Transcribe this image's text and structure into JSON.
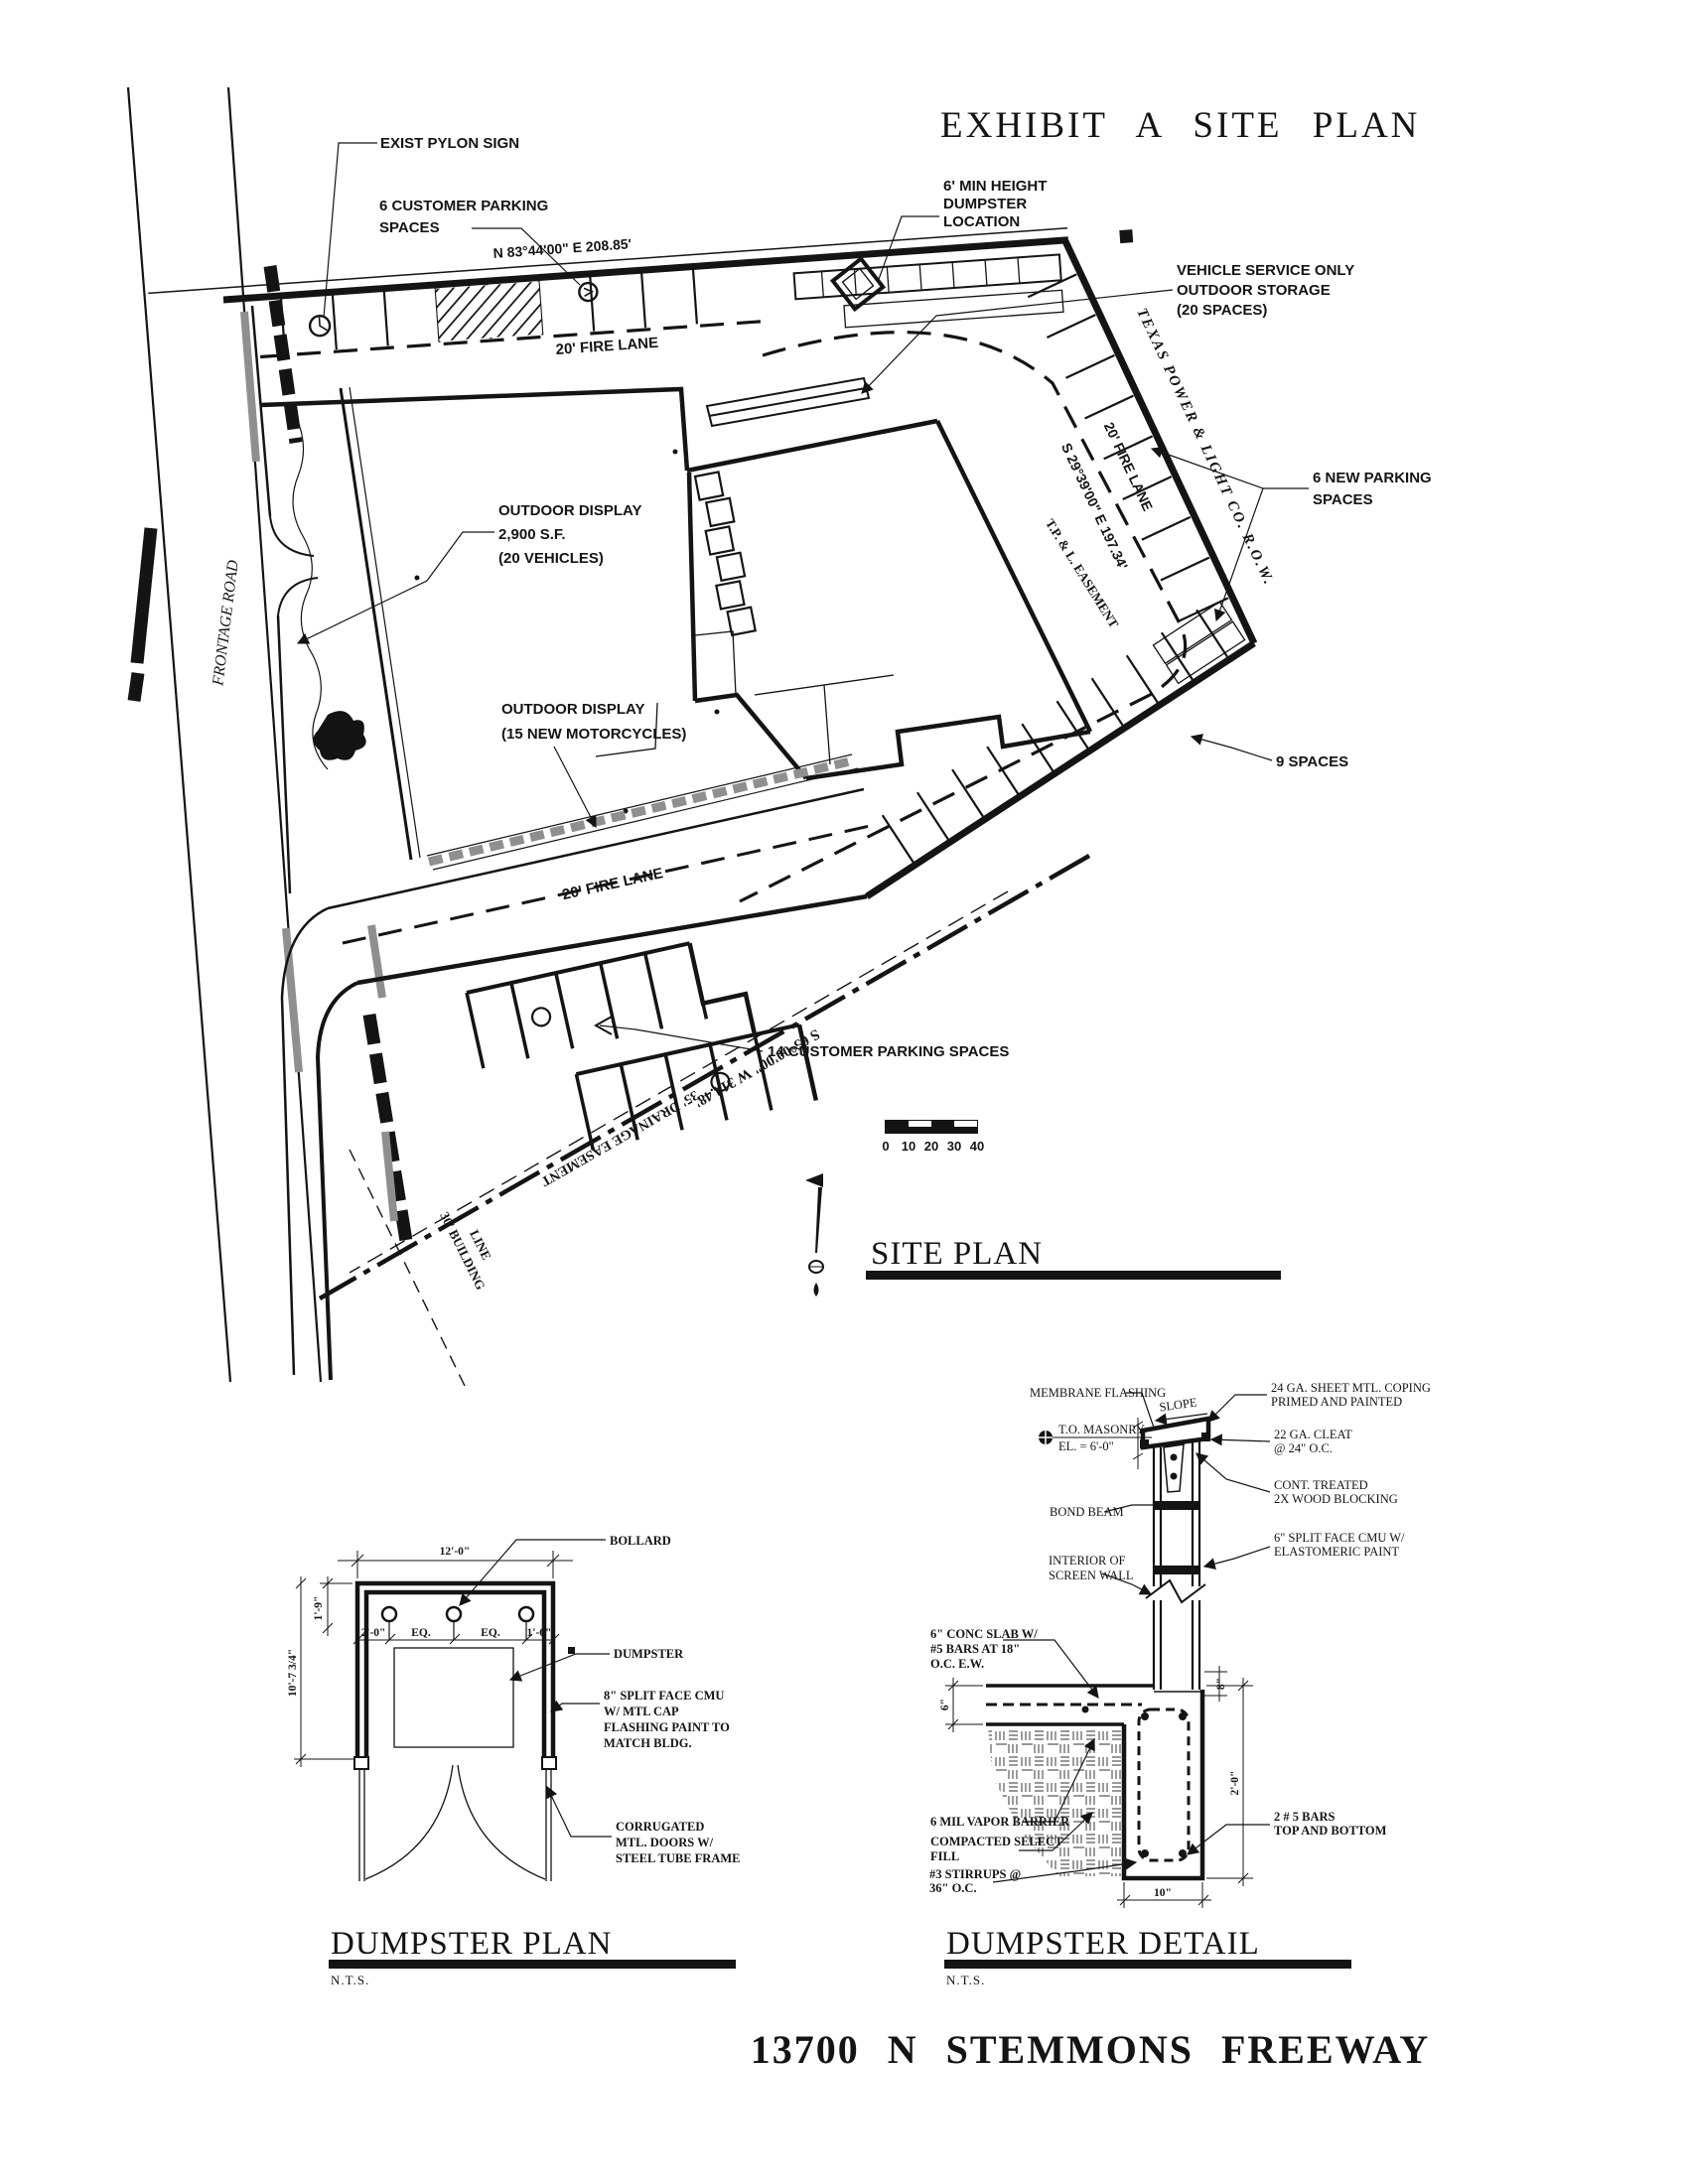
{
  "colors": {
    "ink": "#141414",
    "gray": "#8f8f8f",
    "paper": "#ffffff"
  },
  "exhibit_title": "EXHIBIT  A  SITE  PLAN",
  "address": "13700  N  STEMMONS  FREEWAY",
  "site": {
    "heading": "SITE PLAN",
    "exist_pylon_sign": "EXIST PYLON SIGN",
    "customer_parking_6": [
      "6 CUSTOMER PARKING",
      "SPACES"
    ],
    "dumpster_location": [
      "6' MIN HEIGHT",
      "DUMPSTER",
      "LOCATION"
    ],
    "vehicle_service": [
      "VEHICLE SERVICE ONLY",
      "OUTDOOR STORAGE",
      "(20 SPACES)"
    ],
    "new_parking_6": [
      "6 NEW PARKING",
      "SPACES"
    ],
    "outdoor_display_vehicles": [
      "OUTDOOR DISPLAY",
      "2,900 S.F.",
      "(20 VEHICLES)"
    ],
    "outdoor_display_motorcycles": [
      "OUTDOOR DISPLAY",
      "(15 NEW MOTORCYCLES)"
    ],
    "customer_parking_14": "14 CUSTOMER PARKING SPACES",
    "spaces_9": "9 SPACES",
    "fire_lane": "20' FIRE LANE",
    "bearing_north": "N 83°44'00\" E    208.85'",
    "bearing_east": "S 29°39'00\" E    197.34'",
    "bearing_south": "S 65°00'00\" W    314.48'",
    "tpl_row": "TEXAS POWER & LIGHT CO. R.O.W.",
    "tpl_easement": "T.P. & L. EASEMENT",
    "drainage_easement": "35' DRAINAGE EASEMENT",
    "building_line": [
      "30' BUILDING",
      "LINE"
    ],
    "frontage_road": "FRONTAGE ROAD",
    "scale_ticks": [
      "0",
      "10",
      "20",
      "30",
      "40"
    ]
  },
  "dumpster_plan": {
    "heading": "DUMPSTER PLAN",
    "nts": "N.T.S.",
    "bollard": "BOLLARD",
    "dumpster": "DUMPSTER",
    "cmu_note": [
      "8\" SPLIT FACE CMU",
      "W/ MTL CAP",
      "FLASHING PAINT TO",
      "MATCH BLDG."
    ],
    "door_note": [
      "CORRUGATED",
      "MTL. DOORS W/",
      "STEEL TUBE FRAME"
    ],
    "dim_width": "12'-0\"",
    "dim_depth": "10'-7 3/4\"",
    "dim_offset": "1'-9\"",
    "dim_left": "2'-0\"",
    "dim_eq1": "EQ.",
    "dim_eq2": "EQ.",
    "dim_right": "1'-6\""
  },
  "dumpster_detail": {
    "heading": "DUMPSTER DETAIL",
    "nts": "N.T.S.",
    "membrane": "MEMBRANE FLASHING",
    "slope": "SLOPE",
    "coping": [
      "24 GA. SHEET MTL. COPING",
      "PRIMED AND PAINTED"
    ],
    "cleat": [
      "22 GA. CLEAT",
      "@ 24\" O.C."
    ],
    "to_masonry": [
      "T.O. MASONRY",
      "EL. = 6'-0\""
    ],
    "blocking": [
      "CONT. TREATED",
      "2X WOOD BLOCKING"
    ],
    "bond_beam": "BOND BEAM",
    "cmu": [
      "6\" SPLIT FACE CMU W/",
      "ELASTOMERIC PAINT"
    ],
    "interior": [
      "INTERIOR OF",
      "SCREEN WALL"
    ],
    "slab": [
      "6\" CONC SLAB W/",
      "#5 BARS AT 18\"",
      "O.C. E.W."
    ],
    "vapor": "6 MIL VAPOR BARRIER",
    "fill": [
      "COMPACTED SELECT",
      "FILL"
    ],
    "stirrups": [
      "#3 STIRRUPS @",
      "36\" O.C."
    ],
    "bars": [
      "2 # 5 BARS",
      "TOP AND BOTTOM"
    ],
    "dim_slab": "6\"",
    "dim_step": "8\"",
    "dim_footing_depth": "2'-0\"",
    "dim_footing_width": "10\""
  }
}
